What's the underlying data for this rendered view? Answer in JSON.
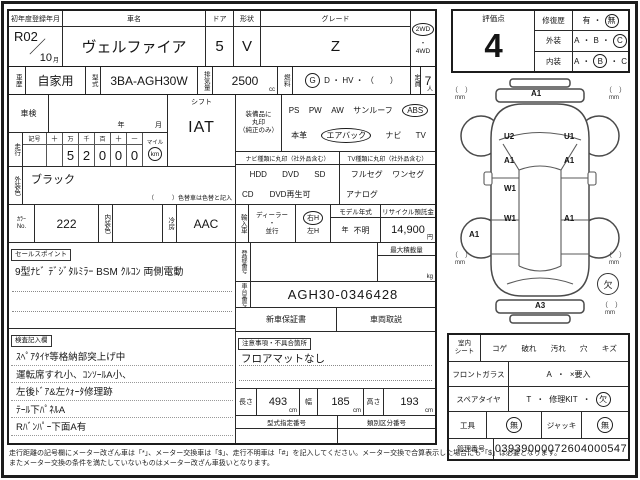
{
  "sym": {
    "dot": "・"
  },
  "top": {
    "reg_label": "初年度登録年月",
    "reg_value": "R02",
    "reg_slash": "／",
    "reg_month": "10",
    "reg_month_unit": "月",
    "name_label": "車名",
    "name_value": "ヴェルファイア",
    "door_label": "ドア",
    "door_value": "5",
    "shape_label": "形状",
    "shape_value": "V",
    "grade_label": "グレード",
    "grade_value": "Z",
    "drive_top": "2WD",
    "drive_bottom": "4WD"
  },
  "row2": {
    "history_label": "車歴",
    "history_value": "自家用",
    "model_label": "型式",
    "model_value": "3BA-AGH30W",
    "disp_label": "排気量",
    "disp_value": "2500",
    "disp_unit": "cc",
    "fuel_label": "燃料",
    "fuel_circled": "G",
    "fuel_rest": "D ・ HV ・ （　　）",
    "cap_label": "定員",
    "cap_value": "7",
    "cap_unit": "人"
  },
  "left": {
    "shaken_label": "車検",
    "shaken_year": "年",
    "shaken_month": "月",
    "shift_label": "シフト",
    "shift_value": "IAT",
    "mileage_label": "走行",
    "mileage_cols": [
      "記号",
      "十",
      "万",
      "千",
      "百",
      "十",
      "一"
    ],
    "mileage_digits": [
      "",
      "",
      "5",
      "2",
      "0",
      "0",
      "0"
    ],
    "mile_label": "マイル",
    "km_label": "km",
    "extcolor_label": "外装色",
    "extcolor_value": "ブラック",
    "extcolor_note": "（　　　）色替車は色替と記入",
    "colorno_label_1": "ｶﾗｰ",
    "colorno_label_2": "No.",
    "colorno_value": "222",
    "intcolor_label": "内装色",
    "ac_label": "冷房",
    "ac_value": "AAC",
    "sales_label": "セールスポイント",
    "sales_text": "9型ﾅﾋﾞ ﾃﾞｼﾞﾀﾙﾐﾗｰ BSM ｸﾙｺﾝ 両側電動",
    "notes_label": "検査記入欄",
    "notes_lines": [
      "ｽﾍﾟｱﾀｲﾔ等格納部突上げ中",
      "運転席すれ小、ｺﾝｿｰﾙA小、",
      "左後ﾄﾞｱ&左ｸｫｰﾀ修理跡",
      "ﾃｰﾙ下ﾊﾟﾈﾙA",
      "Rﾊﾞﾝﾊﾟｰ下面A有"
    ]
  },
  "mid": {
    "equip_label_1": "装備品に",
    "equip_label_2": "丸印",
    "equip_label_3": "（純正のみ）",
    "equip_row1": [
      "PS",
      "PW",
      "AW",
      "サンルーフ"
    ],
    "equip_abs": "ABS",
    "equip_leather": "本革",
    "equip_airbag": "エアバック",
    "equip_navi": "ナビ",
    "equip_tv": "TV",
    "nav_header": "ナビ種類に丸印（社外品含む）",
    "nav_row1": [
      "HDD",
      "DVD",
      "SD"
    ],
    "nav_row2": [
      "CD",
      "DVD再生可"
    ],
    "tv_header": "TV種類に丸印（社外品含む）",
    "tv_row1": [
      "フルセグ",
      "ワンセグ"
    ],
    "tv_row2": [
      "アナログ"
    ],
    "import_label": "輸入車",
    "dealer_top": "ディーラー",
    "dealer_bottom": "並行",
    "rh": "右H",
    "lh": "左H",
    "model_year_label": "モデル年式",
    "model_year_year": "年",
    "model_year_value": "不明",
    "recycle_label": "リサイクル預託金",
    "recycle_value": "14,900",
    "recycle_unit": "円",
    "regno_label": "登録番号",
    "maxload_label": "最大積載量",
    "maxload_unit": "kg",
    "chassis_label": "車台番号",
    "chassis_value": "AGH30-0346428",
    "warranty_label": "新車保証書",
    "manual_label": "車両取説",
    "caution_label": "注意事項・不具合箇所",
    "caution_text": "フロアマットなし",
    "len_label": "長さ",
    "len_value": "493",
    "len_unit": "cm",
    "wid_label": "幅",
    "wid_value": "185",
    "wid_unit": "cm",
    "hei_label": "高さ",
    "hei_value": "193",
    "hei_unit": "cm",
    "type_desig_label": "型式指定番号",
    "class_label": "類別区分番号"
  },
  "rating": {
    "label": "評価点",
    "score": "4",
    "repair_label": "修復歴",
    "repair_yes": "有",
    "repair_no": "無",
    "ext_label": "外装",
    "int_label": "内装",
    "a": "A",
    "b": "B",
    "c": "C"
  },
  "diagram": {
    "labels": [
      "A1",
      "U2",
      "U1",
      "A1",
      "A1",
      "W1",
      "W1",
      "A1",
      "A1",
      "A3"
    ],
    "missing": "欠",
    "bracket": "（　）",
    "mm": "mm"
  },
  "cond": {
    "seat_label_1": "室内",
    "seat_label_2": "シート",
    "seat_items": [
      "コゲ",
      "破れ",
      "汚れ",
      "穴",
      "キズ"
    ],
    "glass_label": "フロントガラス",
    "glass_a": "A",
    "glass_x": "×要入",
    "spare_label": "スペアタイヤ",
    "spare_t": "T",
    "spare_kit": "修理KIT",
    "spare_missing": "欠",
    "tool_label": "工具",
    "tool_value": "無",
    "jack_label": "ジャッキ",
    "jack_value": "無",
    "mgmt_label": "管理番号",
    "mgmt_value": "03939000072604000547"
  },
  "footer": {
    "line1": "走行距離の記号欄にメーター改ざん車は「*」、メーター交換車は「$」、走行不明車は「#」を記入してください。メーター交換で合算表示した場合にも「$」は必要となります。",
    "line2": "またメーター交換の条件を満たしていないものはメーター改ざん車扱いとなります。"
  }
}
